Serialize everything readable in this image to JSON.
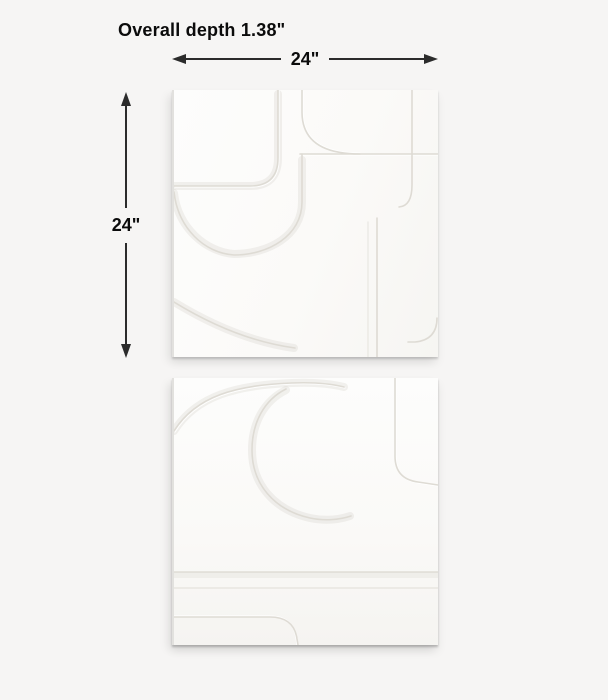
{
  "diagram": {
    "kind": "product-dimension-diagram",
    "annotations": {
      "depth_label": "Overall depth 1.38\"",
      "width_label": "24\"",
      "height_label": "24\""
    },
    "panels": [
      {
        "name": "top-relief-panel",
        "description": "white geometric relief wall-art square"
      },
      {
        "name": "bottom-relief-panel",
        "description": "white geometric relief wall-art square"
      }
    ],
    "colors": {
      "background": "#f6f5f4",
      "panel_face": "#fbfaf8",
      "dimension_line": "#2b2b2b",
      "text": "#0b0b0b",
      "relief_line": "#dedbd4"
    }
  }
}
